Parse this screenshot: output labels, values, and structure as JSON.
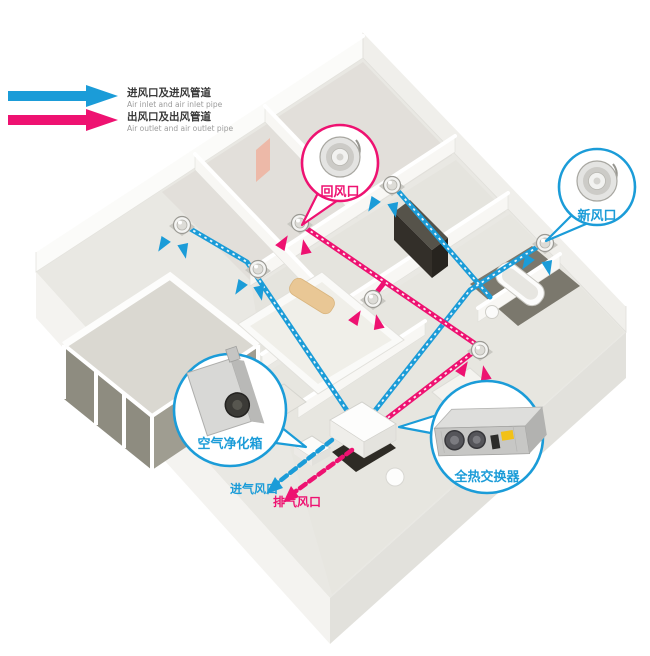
{
  "legend": {
    "items": [
      {
        "id": "air-inlet",
        "label": "进风口及进风管道",
        "sublabel": "Air inlet and air inlet pipe",
        "color": "#1b9cd8"
      },
      {
        "id": "air-outlet",
        "label": "出风口及出风管道",
        "sublabel": "Air outlet and air outlet pipe",
        "color": "#ee1271"
      }
    ]
  },
  "callouts": {
    "return_air_vent": {
      "label": "回风口",
      "color": "#ee1271",
      "icon": "round-ceiling-diffuser"
    },
    "fresh_air_vent": {
      "label": "新风口",
      "color": "#1b9cd8",
      "icon": "round-ceiling-diffuser"
    },
    "air_purifier_box": {
      "label": "空气净化箱",
      "color": "#1b9cd8",
      "icon": "air-purifier-unit"
    },
    "heat_exchanger": {
      "label": "全热交换器",
      "color": "#1b9cd8",
      "icon": "total-heat-exchanger-unit"
    }
  },
  "duct_labels": {
    "air_intake": {
      "label": "进气风口",
      "color": "#1b9cd8"
    },
    "air_exhaust": {
      "label": "排气风口",
      "color": "#ee1271"
    }
  },
  "colors": {
    "supply_blue": "#1b9cd8",
    "exhaust_pink": "#ee1271"
  }
}
